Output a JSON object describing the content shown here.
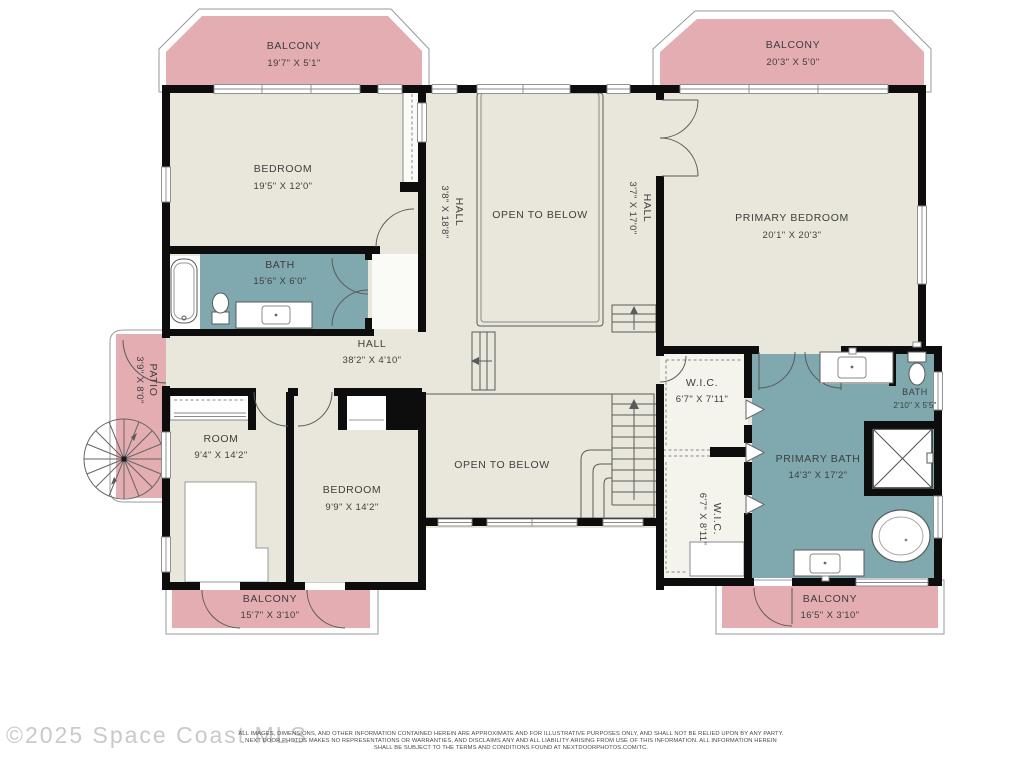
{
  "plan": {
    "balcony_tl": {
      "label": "BALCONY",
      "dims": "19'7\" X 5'1\""
    },
    "balcony_tr": {
      "label": "BALCONY",
      "dims": "20'3\" X 5'0\""
    },
    "bedroom_tl": {
      "label": "BEDROOM",
      "dims": "19'5\" X 12'0\""
    },
    "bath_tl": {
      "label": "BATH",
      "dims": "15'6\" X 6'0\""
    },
    "hall_left": {
      "label": "HALL",
      "dims": "3'8\" X 18'8\""
    },
    "open_below_top": {
      "label": "OPEN TO BELOW"
    },
    "hall_right": {
      "label": "HALL",
      "dims": "3'7\" X 17'0\""
    },
    "primary_bedroom": {
      "label": "PRIMARY BEDROOM",
      "dims": "20'1\" X 20'3\""
    },
    "hall_main": {
      "label": "HALL",
      "dims": "38'2\" X 4'10\""
    },
    "patio": {
      "label": "PATIO",
      "dims": "3'9\" X 8'0\""
    },
    "room": {
      "label": "ROOM",
      "dims": "9'4\" X 14'2\""
    },
    "bedroom_b": {
      "label": "BEDROOM",
      "dims": "9'9\" X 14'2\""
    },
    "open_below_bottom": {
      "label": "OPEN TO BELOW"
    },
    "wic_1": {
      "label": "W.I.C.",
      "dims": "6'7\" X 7'11\""
    },
    "wic_2": {
      "label": "W.I.C.",
      "dims": "6'7\" X 8'11\""
    },
    "primary_bath": {
      "label": "PRIMARY BATH",
      "dims": "14'3\" X 17'2\""
    },
    "bath_small": {
      "label": "BATH",
      "dims": "2'10\" X 5'5\""
    },
    "balcony_bl": {
      "label": "BALCONY",
      "dims": "15'7\" X 3'10\""
    },
    "balcony_br": {
      "label": "BALCONY",
      "dims": "16'5\" X 3'10\""
    }
  },
  "footer": {
    "watermark": "©2025 Space Coast MLS",
    "disclaimer": [
      "ALL IMAGES, DIMENSIONS, AND OTHER INFORMATION CONTAINED HEREIN ARE APPROXIMATE AND FOR ILLUSTRATIVE PURPOSES ONLY, AND SHALL NOT BE RELIED UPON BY ANY PARTY.",
      "NEXT DOOR PHOTOS MAKES NO REPRESENTATIONS OR WARRANTIES, AND DISCLAIMS ANY AND ALL LIABILITY ARISING FROM USE OF THIS INFORMATION. ALL INFORMATION HEREIN",
      "SHALL BE SUBJECT TO THE TERMS AND CONDITIONS FOUND AT NEXTDOORPHOTOS.COM/TC."
    ]
  },
  "colors": {
    "floor": "#e9e7dc",
    "balcony": "#e3adb2",
    "bath": "#7fa8af",
    "wall": "#0d0d0d"
  }
}
